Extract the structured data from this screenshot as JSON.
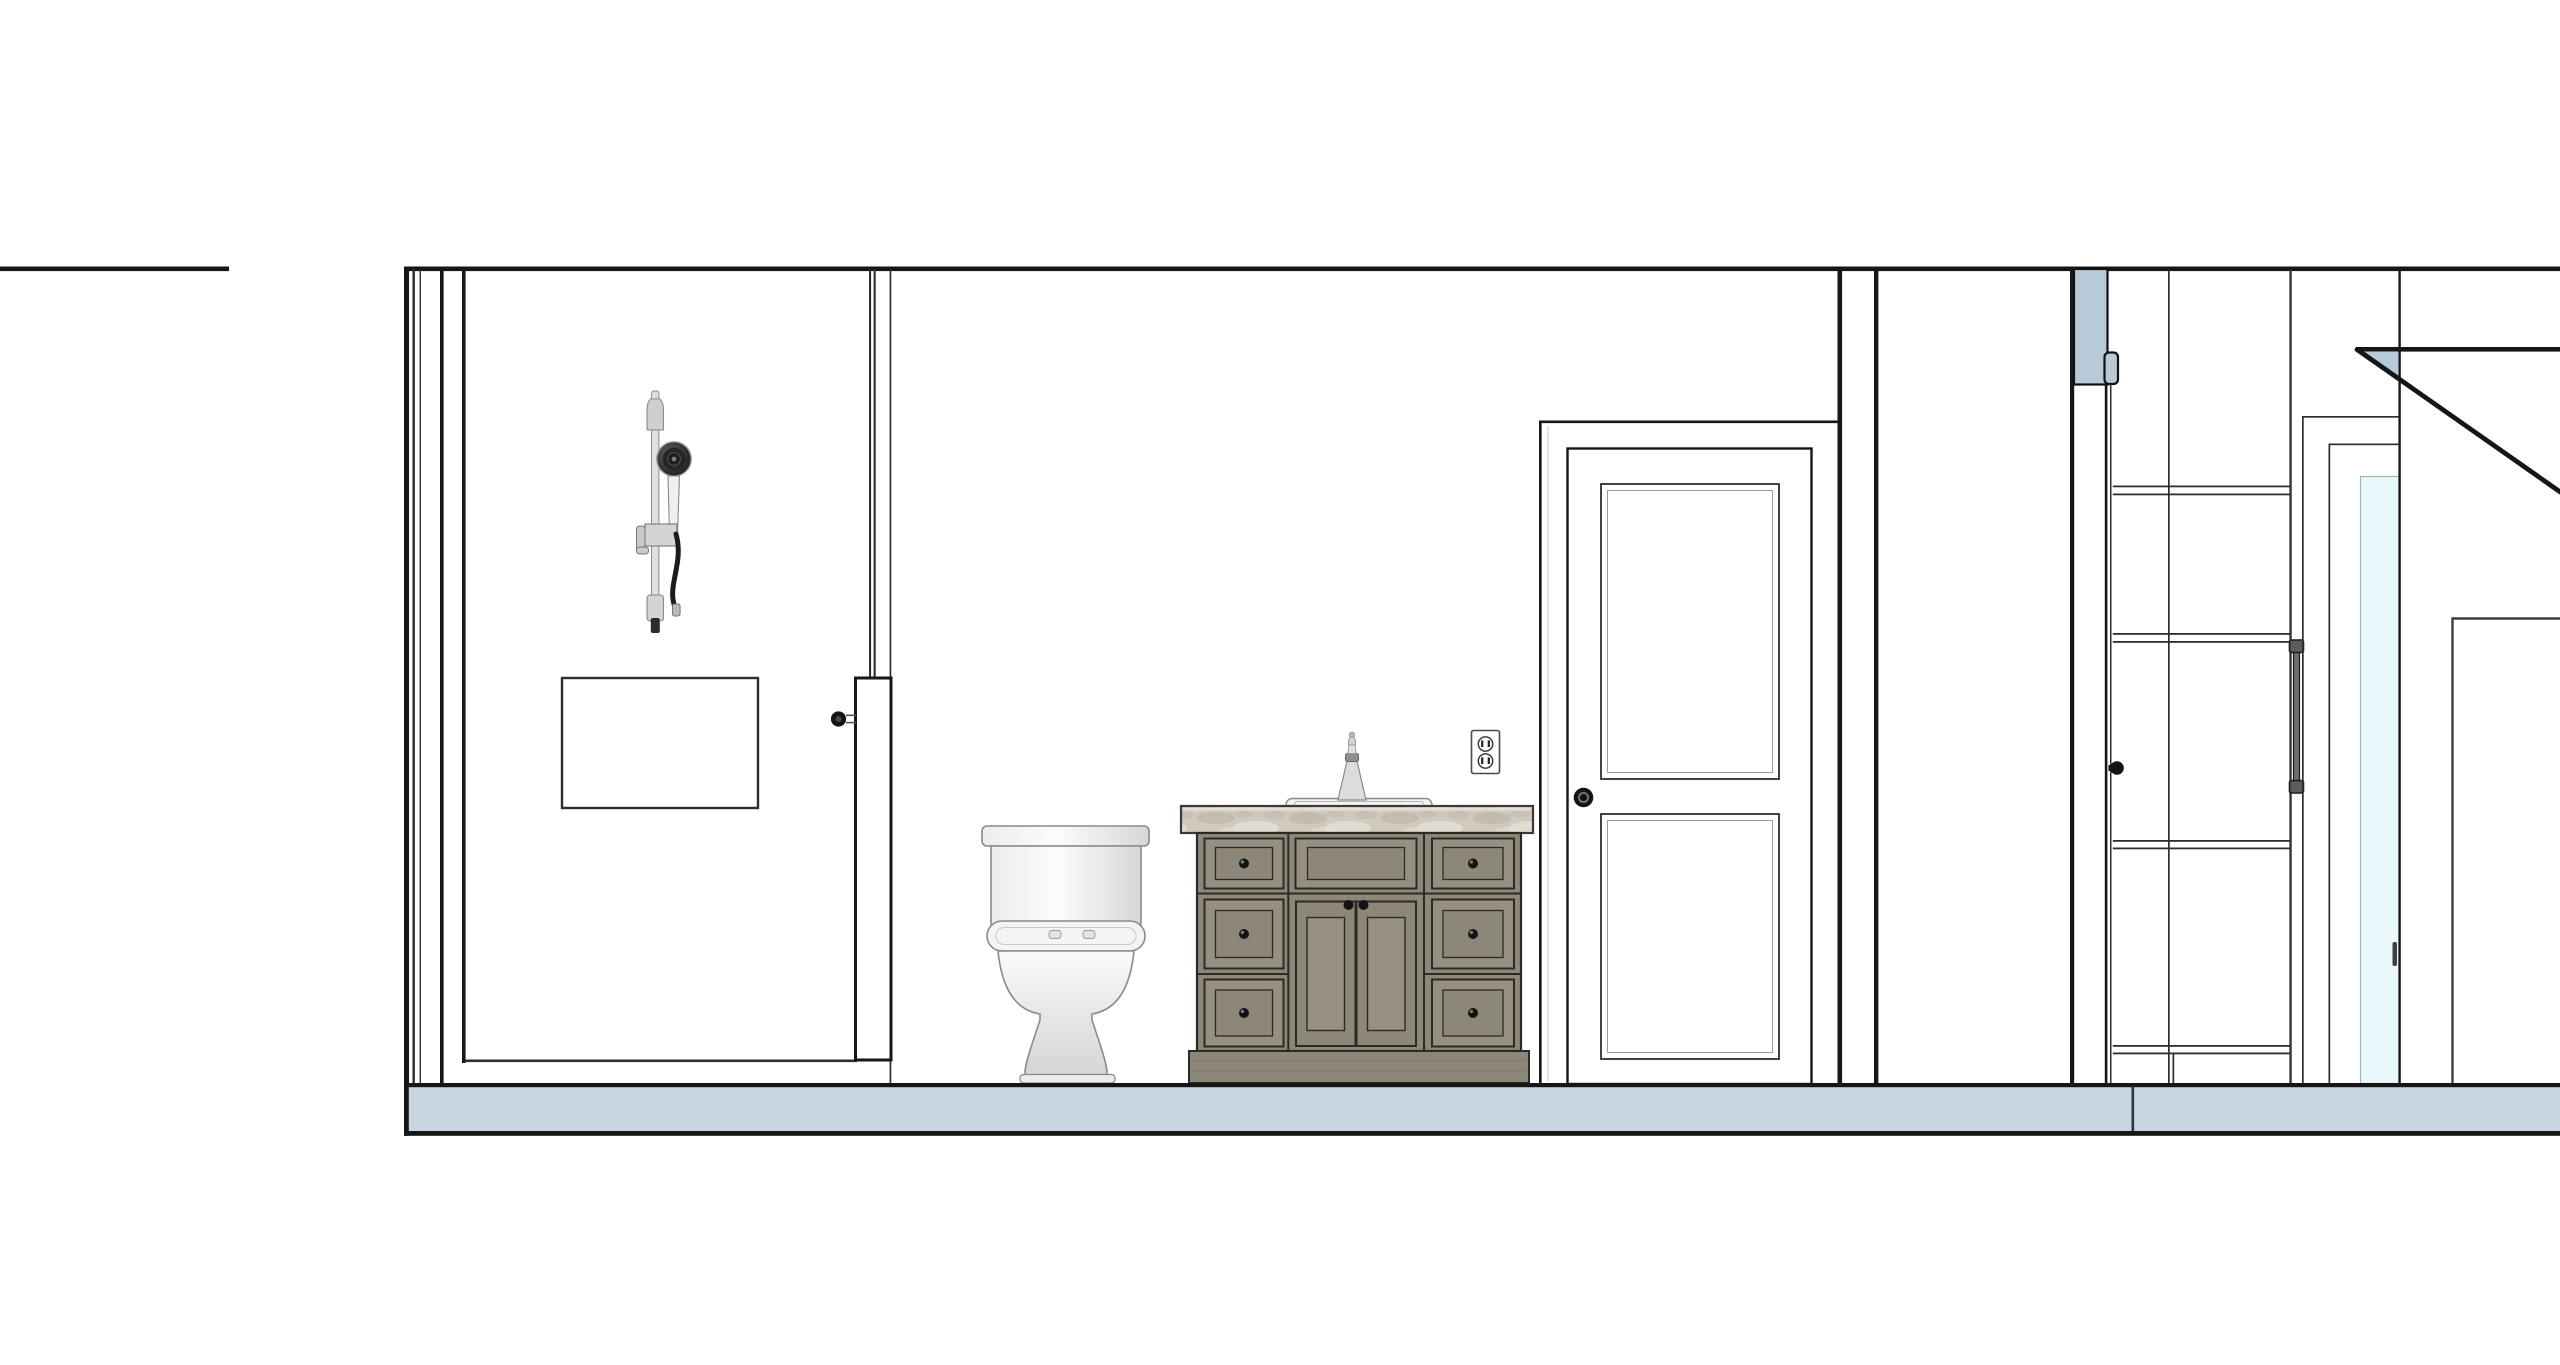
{
  "document": {
    "type": "interior-elevation-drawing",
    "description": "Black-line architectural interior elevation of a bathroom (shower with hand shower and niche, glass partition, toilet, marble-top vanity, duplex outlet, two-panel door) and an adjacent closet/hall bay with shelving, towel bar, glass mirror panel and a section-cut sloped ceiling over a tile floor band.",
    "background": "#ffffff"
  },
  "colors": {
    "line_ink": "#161616",
    "line_mid": "#2e2e2e",
    "floor_fill": "#c8d5e0",
    "floor_seam": "#2b353d",
    "poche_fill": "#b7cad8",
    "glass_fill": "#eaf8fb",
    "glass_edge": "#9ab4b6",
    "wood_base": "#8d8779",
    "wood_panel": "#968f82",
    "wood_line": "#2b2b26",
    "counter_base": "#cfc9be",
    "counter_vein_dark": "#b8b1a3",
    "counter_vein_light": "#e3dfd5",
    "fixture_outline": "#8a8a8a",
    "metal_light": "#dcdcdc",
    "metal_mid": "#9a9a9a",
    "knob_black": "#131313",
    "hose_black": "#1b1b1b"
  },
  "components": {
    "bathroom": {
      "shower": {
        "fixture": "handheld-shower-on-slide-bar",
        "niche": "recessed-wall-niche",
        "partition": "glass-partition-with-lower-panel",
        "partition_knob": "round-black-pull"
      },
      "toilet": "two-piece-toilet-front-view",
      "vanity": {
        "counter": "marble-countertop",
        "sink": "drop-in-sink-with-single-faucet",
        "drawers_left": 3,
        "drawers_right": 3,
        "center": "false-front-above-double-doors",
        "knob_style": "round-black"
      },
      "outlet": "duplex-receptacle",
      "door": {
        "style": "two-panel-door-with-casing",
        "knob": "round-black"
      }
    },
    "adjacent_room": {
      "jamb_section": "poche-cut-wall-with-hinge-tab",
      "open_door_edge": "door-seen-on-edge-with-knob",
      "closet": {
        "shelves": 4,
        "vertical_divider": 1,
        "towel_bar": 1
      },
      "mirror_panel": "tall-glass-panel-with-small-handle",
      "sloped_ceiling": "section-cut-diagonal-with-poche-triangle",
      "far_opening": "large-wall-opening-corner"
    },
    "floor": {
      "finish": "tile-floor-band-in-section",
      "seam_count": 1
    }
  }
}
